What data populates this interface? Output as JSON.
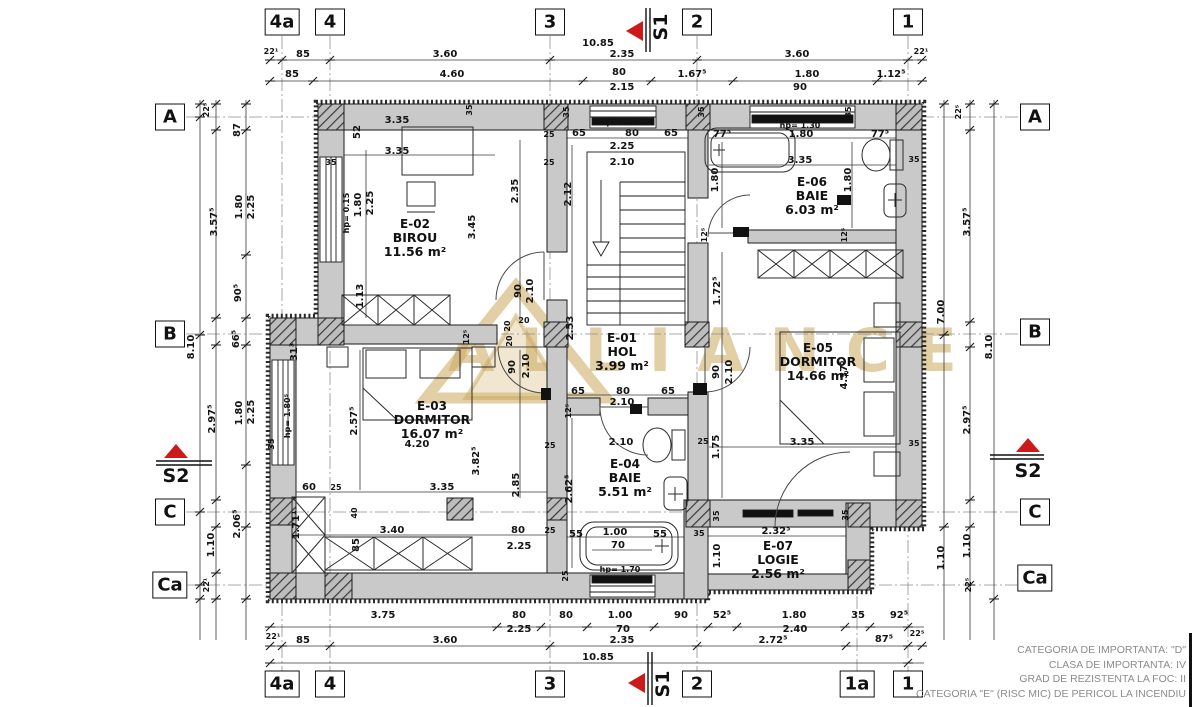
{
  "watermark": {
    "text": "ALLIANCE"
  },
  "grid": {
    "top": [
      {
        "label": "4a",
        "x": 282
      },
      {
        "label": "4",
        "x": 330
      },
      {
        "label": "3",
        "x": 550
      },
      {
        "label": "2",
        "x": 697
      },
      {
        "label": "1",
        "x": 908
      }
    ],
    "bottom": [
      {
        "label": "4a",
        "x": 282
      },
      {
        "label": "4",
        "x": 330
      },
      {
        "label": "3",
        "x": 550
      },
      {
        "label": "2",
        "x": 697
      },
      {
        "label": "1a",
        "x": 857
      },
      {
        "label": "1",
        "x": 908
      }
    ],
    "left": [
      {
        "label": "A",
        "y": 117
      },
      {
        "label": "B",
        "y": 334
      },
      {
        "label": "C",
        "y": 512
      },
      {
        "label": "Ca",
        "y": 585
      }
    ],
    "right": [
      {
        "label": "A",
        "y": 117
      },
      {
        "label": "B",
        "y": 332
      },
      {
        "label": "C",
        "y": 512
      },
      {
        "label": "Ca",
        "y": 578
      }
    ]
  },
  "sections": {
    "s1_label": "S1",
    "s2_label": "S2"
  },
  "rooms": [
    {
      "id": "E-02",
      "name": "BIROU",
      "area": "11.56 m²",
      "x": 415,
      "y": 238
    },
    {
      "id": "E-06",
      "name": "BAIE",
      "area": "6.03 m²",
      "x": 812,
      "y": 196
    },
    {
      "id": "E-01",
      "name": "HOL",
      "area": "3.99 m²",
      "x": 622,
      "y": 352
    },
    {
      "id": "E-05",
      "name": "DORMITOR",
      "area": "14.66 m²",
      "x": 818,
      "y": 362
    },
    {
      "id": "E-03",
      "name": "DORMITOR",
      "area": "16.07 m²",
      "x": 432,
      "y": 420
    },
    {
      "id": "E-04",
      "name": "BAIE",
      "area": "5.51 m²",
      "x": 625,
      "y": 478
    },
    {
      "id": "E-07",
      "name": "LOGIE",
      "area": "2.56 m²",
      "x": 778,
      "y": 560
    }
  ],
  "dims": [
    {
      "t": "10.85",
      "x": 598,
      "y": 44
    },
    {
      "t": "22¹",
      "x": 271,
      "y": 52,
      "s": 1
    },
    {
      "t": "85",
      "x": 303,
      "y": 55
    },
    {
      "t": "3.60",
      "x": 445,
      "y": 55
    },
    {
      "t": "2.35",
      "x": 622,
      "y": 55
    },
    {
      "t": "3.60",
      "x": 797,
      "y": 55
    },
    {
      "t": "22¹",
      "x": 921,
      "y": 52,
      "s": 1
    },
    {
      "t": "85",
      "x": 292,
      "y": 75
    },
    {
      "t": "4.60",
      "x": 452,
      "y": 75
    },
    {
      "t": "80",
      "x": 619,
      "y": 73
    },
    {
      "t": "1.67⁵",
      "x": 692,
      "y": 75
    },
    {
      "t": "1.80",
      "x": 807,
      "y": 75
    },
    {
      "t": "1.12⁵",
      "x": 891,
      "y": 75
    },
    {
      "t": "2.15",
      "x": 622,
      "y": 88
    },
    {
      "t": "90",
      "x": 800,
      "y": 88
    },
    {
      "t": "3.75",
      "x": 383,
      "y": 616
    },
    {
      "t": "80",
      "x": 519,
      "y": 616
    },
    {
      "t": "80",
      "x": 566,
      "y": 616
    },
    {
      "t": "1.00",
      "x": 620,
      "y": 616
    },
    {
      "t": "90",
      "x": 681,
      "y": 616
    },
    {
      "t": "52⁵",
      "x": 722,
      "y": 616
    },
    {
      "t": "1.80",
      "x": 794,
      "y": 616
    },
    {
      "t": "35",
      "x": 858,
      "y": 616
    },
    {
      "t": "92⁵",
      "x": 899,
      "y": 616
    },
    {
      "t": "2.25",
      "x": 519,
      "y": 630
    },
    {
      "t": "70",
      "x": 623,
      "y": 630
    },
    {
      "t": "2.40",
      "x": 795,
      "y": 630
    },
    {
      "t": "22¹",
      "x": 273,
      "y": 637,
      "s": 1
    },
    {
      "t": "85",
      "x": 303,
      "y": 641
    },
    {
      "t": "3.60",
      "x": 445,
      "y": 641
    },
    {
      "t": "2.35",
      "x": 622,
      "y": 641
    },
    {
      "t": "2.72⁵",
      "x": 773,
      "y": 641
    },
    {
      "t": "87⁵",
      "x": 884,
      "y": 640
    },
    {
      "t": "22⁵",
      "x": 917,
      "y": 634,
      "s": 1
    },
    {
      "t": "10.85",
      "x": 598,
      "y": 658
    },
    {
      "t": "22⁵",
      "x": 207,
      "y": 110,
      "r": 1,
      "s": 1
    },
    {
      "t": "87",
      "x": 238,
      "y": 130,
      "r": 1
    },
    {
      "t": "1.80",
      "x": 240,
      "y": 207,
      "r": 1
    },
    {
      "t": "2.25",
      "x": 252,
      "y": 207,
      "r": 1
    },
    {
      "t": "3.57⁵",
      "x": 215,
      "y": 222,
      "r": 1
    },
    {
      "t": "90⁵",
      "x": 239,
      "y": 293,
      "r": 1
    },
    {
      "t": "66⁵",
      "x": 237,
      "y": 339,
      "r": 1
    },
    {
      "t": "8.10",
      "x": 192,
      "y": 347,
      "r": 1
    },
    {
      "t": "31³",
      "x": 295,
      "y": 352,
      "r": 1
    },
    {
      "t": "2.97⁵",
      "x": 213,
      "y": 419,
      "r": 1
    },
    {
      "t": "1.80",
      "x": 240,
      "y": 413,
      "r": 1
    },
    {
      "t": "2.25",
      "x": 252,
      "y": 412,
      "r": 1
    },
    {
      "t": "2.06⁵",
      "x": 238,
      "y": 524,
      "r": 1
    },
    {
      "t": "1.10",
      "x": 212,
      "y": 545,
      "r": 1
    },
    {
      "t": "22¹",
      "x": 207,
      "y": 585,
      "r": 1,
      "s": 1
    },
    {
      "t": "22⁵",
      "x": 959,
      "y": 112,
      "r": 1,
      "s": 1
    },
    {
      "t": "3.57⁵",
      "x": 968,
      "y": 222,
      "r": 1
    },
    {
      "t": "7.00",
      "x": 942,
      "y": 312,
      "r": 1
    },
    {
      "t": "8.10",
      "x": 990,
      "y": 347,
      "r": 1
    },
    {
      "t": "2.97⁵",
      "x": 968,
      "y": 420,
      "r": 1
    },
    {
      "t": "1.10",
      "x": 968,
      "y": 546,
      "r": 1
    },
    {
      "t": "1.10",
      "x": 942,
      "y": 558,
      "r": 1
    },
    {
      "t": "22⁵",
      "x": 969,
      "y": 585,
      "r": 1,
      "s": 1
    },
    {
      "t": "3.35",
      "x": 397,
      "y": 121
    },
    {
      "t": "3.35",
      "x": 397,
      "y": 152
    },
    {
      "t": "52",
      "x": 358,
      "y": 132,
      "r": 1
    },
    {
      "t": "35",
      "x": 331,
      "y": 163,
      "s": 1
    },
    {
      "t": "hp= 0.15",
      "x": 347,
      "y": 213,
      "r": 1,
      "s": 1
    },
    {
      "t": "1.80",
      "x": 359,
      "y": 205,
      "r": 1
    },
    {
      "t": "2.25",
      "x": 371,
      "y": 203,
      "r": 1
    },
    {
      "t": "3.45",
      "x": 473,
      "y": 227,
      "r": 1
    },
    {
      "t": "2.35",
      "x": 516,
      "y": 191,
      "r": 1
    },
    {
      "t": "25",
      "x": 549,
      "y": 135,
      "s": 1
    },
    {
      "t": "25",
      "x": 549,
      "y": 163,
      "s": 1
    },
    {
      "t": "1.13",
      "x": 361,
      "y": 296,
      "r": 1
    },
    {
      "t": "90",
      "x": 519,
      "y": 291,
      "r": 1
    },
    {
      "t": "2.10",
      "x": 531,
      "y": 291,
      "r": 1
    },
    {
      "t": "35",
      "x": 470,
      "y": 110,
      "r": 1,
      "s": 1
    },
    {
      "t": "hp= 0.15",
      "x": 621,
      "y": 123,
      "s": 1
    },
    {
      "t": "65",
      "x": 579,
      "y": 134
    },
    {
      "t": "80",
      "x": 632,
      "y": 134
    },
    {
      "t": "65",
      "x": 671,
      "y": 134
    },
    {
      "t": "2.25",
      "x": 622,
      "y": 147
    },
    {
      "t": "2.10",
      "x": 622,
      "y": 163
    },
    {
      "t": "2.12",
      "x": 569,
      "y": 194,
      "r": 1
    },
    {
      "t": "2.53",
      "x": 571,
      "y": 328,
      "r": 1
    },
    {
      "t": "35",
      "x": 567,
      "y": 112,
      "r": 1,
      "s": 1
    },
    {
      "t": "35",
      "x": 702,
      "y": 112,
      "r": 1,
      "s": 1
    },
    {
      "t": "35",
      "x": 849,
      "y": 112,
      "r": 1,
      "s": 1
    },
    {
      "t": "20",
      "x": 524,
      "y": 321,
      "s": 1
    },
    {
      "t": "20",
      "x": 508,
      "y": 326,
      "r": 1,
      "s": 1
    },
    {
      "t": "20",
      "x": 510,
      "y": 341,
      "r": 1,
      "s": 1
    },
    {
      "t": "12⁵",
      "x": 467,
      "y": 337,
      "r": 1,
      "s": 1
    },
    {
      "t": "77⁵",
      "x": 722,
      "y": 135
    },
    {
      "t": "1.80",
      "x": 801,
      "y": 135
    },
    {
      "t": "77⁵",
      "x": 880,
      "y": 135
    },
    {
      "t": "3.35",
      "x": 800,
      "y": 161
    },
    {
      "t": "1.80",
      "x": 716,
      "y": 180,
      "r": 1
    },
    {
      "t": "1.80",
      "x": 849,
      "y": 180,
      "r": 1
    },
    {
      "t": "35",
      "x": 914,
      "y": 160,
      "s": 1
    },
    {
      "t": "12⁵",
      "x": 705,
      "y": 235,
      "r": 1,
      "s": 1
    },
    {
      "t": "12⁵",
      "x": 845,
      "y": 235,
      "r": 1,
      "s": 1
    },
    {
      "t": "hp= 1.30",
      "x": 800,
      "y": 126,
      "s": 1
    },
    {
      "t": "1.72⁵",
      "x": 718,
      "y": 291,
      "r": 1
    },
    {
      "t": "90",
      "x": 717,
      "y": 372,
      "r": 1
    },
    {
      "t": "2.10",
      "x": 730,
      "y": 372,
      "r": 1
    },
    {
      "t": "4.37⁵",
      "x": 845,
      "y": 375,
      "r": 1
    },
    {
      "t": "3.35",
      "x": 802,
      "y": 443
    },
    {
      "t": "1.75",
      "x": 717,
      "y": 447,
      "r": 1
    },
    {
      "t": "35",
      "x": 914,
      "y": 444,
      "s": 1
    },
    {
      "t": "2.85",
      "x": 517,
      "y": 485,
      "r": 1
    },
    {
      "t": "2.57⁵",
      "x": 355,
      "y": 421,
      "r": 1
    },
    {
      "t": "4.20",
      "x": 417,
      "y": 445
    },
    {
      "t": "3.82⁵",
      "x": 477,
      "y": 461,
      "r": 1
    },
    {
      "t": "60",
      "x": 309,
      "y": 488
    },
    {
      "t": "25",
      "x": 336,
      "y": 488,
      "s": 1
    },
    {
      "t": "3.35",
      "x": 442,
      "y": 488
    },
    {
      "t": "40",
      "x": 355,
      "y": 513,
      "r": 1,
      "s": 1
    },
    {
      "t": "1.71¹",
      "x": 297,
      "y": 525,
      "r": 1
    },
    {
      "t": "3.40",
      "x": 392,
      "y": 531
    },
    {
      "t": "85",
      "x": 357,
      "y": 545,
      "r": 1
    },
    {
      "t": "80",
      "x": 518,
      "y": 531
    },
    {
      "t": "2.25",
      "x": 519,
      "y": 547
    },
    {
      "t": "25",
      "x": 550,
      "y": 531,
      "s": 1
    },
    {
      "t": "25",
      "x": 550,
      "y": 446,
      "s": 1
    },
    {
      "t": "hp= 1.80⁵",
      "x": 288,
      "y": 416,
      "r": 1,
      "s": 1
    },
    {
      "t": "35",
      "x": 272,
      "y": 444,
      "r": 1,
      "s": 1
    },
    {
      "t": "90",
      "x": 513,
      "y": 367,
      "r": 1
    },
    {
      "t": "2.10",
      "x": 527,
      "y": 366,
      "r": 1
    },
    {
      "t": "65",
      "x": 578,
      "y": 392
    },
    {
      "t": "80",
      "x": 623,
      "y": 392
    },
    {
      "t": "65",
      "x": 668,
      "y": 392
    },
    {
      "t": "2.10",
      "x": 622,
      "y": 403
    },
    {
      "t": "12⁵",
      "x": 569,
      "y": 411,
      "r": 1,
      "s": 1
    },
    {
      "t": "2.10",
      "x": 621,
      "y": 443
    },
    {
      "t": "25",
      "x": 703,
      "y": 442,
      "s": 1
    },
    {
      "t": "2.62⁵",
      "x": 570,
      "y": 489,
      "r": 1
    },
    {
      "t": "55",
      "x": 576,
      "y": 535
    },
    {
      "t": "1.00",
      "x": 615,
      "y": 533
    },
    {
      "t": "55",
      "x": 660,
      "y": 535
    },
    {
      "t": "70",
      "x": 618,
      "y": 546
    },
    {
      "t": "35",
      "x": 699,
      "y": 534,
      "s": 1
    },
    {
      "t": "35",
      "x": 717,
      "y": 516,
      "r": 1,
      "s": 1
    },
    {
      "t": "25",
      "x": 566,
      "y": 576,
      "r": 1,
      "s": 1
    },
    {
      "t": "hp= 1.70",
      "x": 620,
      "y": 570,
      "s": 1
    },
    {
      "t": "2.32⁵",
      "x": 776,
      "y": 532
    },
    {
      "t": "1.10",
      "x": 718,
      "y": 556,
      "r": 1
    },
    {
      "t": "35",
      "x": 846,
      "y": 515,
      "r": 1,
      "s": 1
    }
  ],
  "notes": [
    "CATEGORIA DE IMPORTANTA: \"D\"",
    "CLASA DE IMPORTANTA: IV",
    "GRAD DE REZISTENTA LA FOC: II",
    "CATEGORIA \"E\" (RISC MIC) DE PERICOL LA INCENDIU"
  ],
  "colors": {
    "wall": "#c9c9c9",
    "line": "#1a1a1a",
    "dim_line": "#3a3a3a",
    "grid_axis": "#8f8f8f",
    "section_red": "#cc1a1a",
    "watermark_gold": "rgba(202,167,92,0.55)",
    "notes_gray": "#8c8c8c"
  }
}
